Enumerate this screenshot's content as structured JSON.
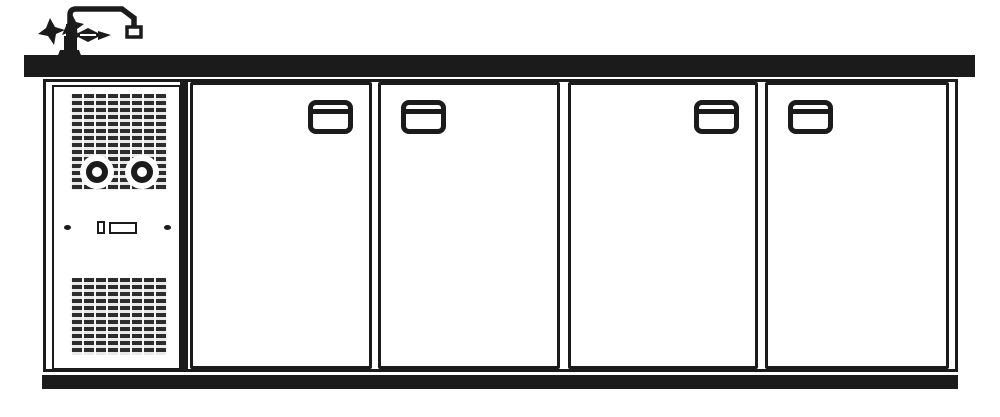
{
  "meta": {
    "description": "Technical line drawing of a four-door back-bar counter cooler with dispensing tap",
    "ink_color": "#1b1b1b",
    "paper_color": "#ffffff"
  },
  "tap": {
    "name": "dispensing-tap",
    "spout_direction": "right",
    "handle_count": 3
  },
  "countertop": {
    "name": "counter-worktop",
    "style": "solid-black-slab"
  },
  "compressor_section": {
    "name": "machine-compartment",
    "grilles": [
      {
        "name": "ventilation-grille-top",
        "pattern": "dashed-louvre"
      },
      {
        "name": "ventilation-grille-bottom",
        "pattern": "dashed-louvre"
      }
    ],
    "knobs": [
      {
        "name": "control-knob-left"
      },
      {
        "name": "control-knob-right"
      }
    ],
    "controls": [
      {
        "name": "fastening-screw-left"
      },
      {
        "name": "toggle-switch"
      },
      {
        "name": "indicator-panel"
      },
      {
        "name": "fastening-screw-right"
      }
    ]
  },
  "doors": [
    {
      "id": 1,
      "name": "door-1",
      "handle_side": "right",
      "left": 144,
      "width": 182
    },
    {
      "id": 2,
      "name": "door-2",
      "handle_side": "left",
      "left": 332,
      "width": 182
    },
    {
      "id": 3,
      "name": "door-3",
      "handle_side": "right",
      "left": 522,
      "width": 190
    },
    {
      "id": 4,
      "name": "door-4",
      "handle_side": "left",
      "left": 719,
      "width": 184
    }
  ],
  "plinth": {
    "name": "base-plinth",
    "style": "solid-black-bar"
  }
}
